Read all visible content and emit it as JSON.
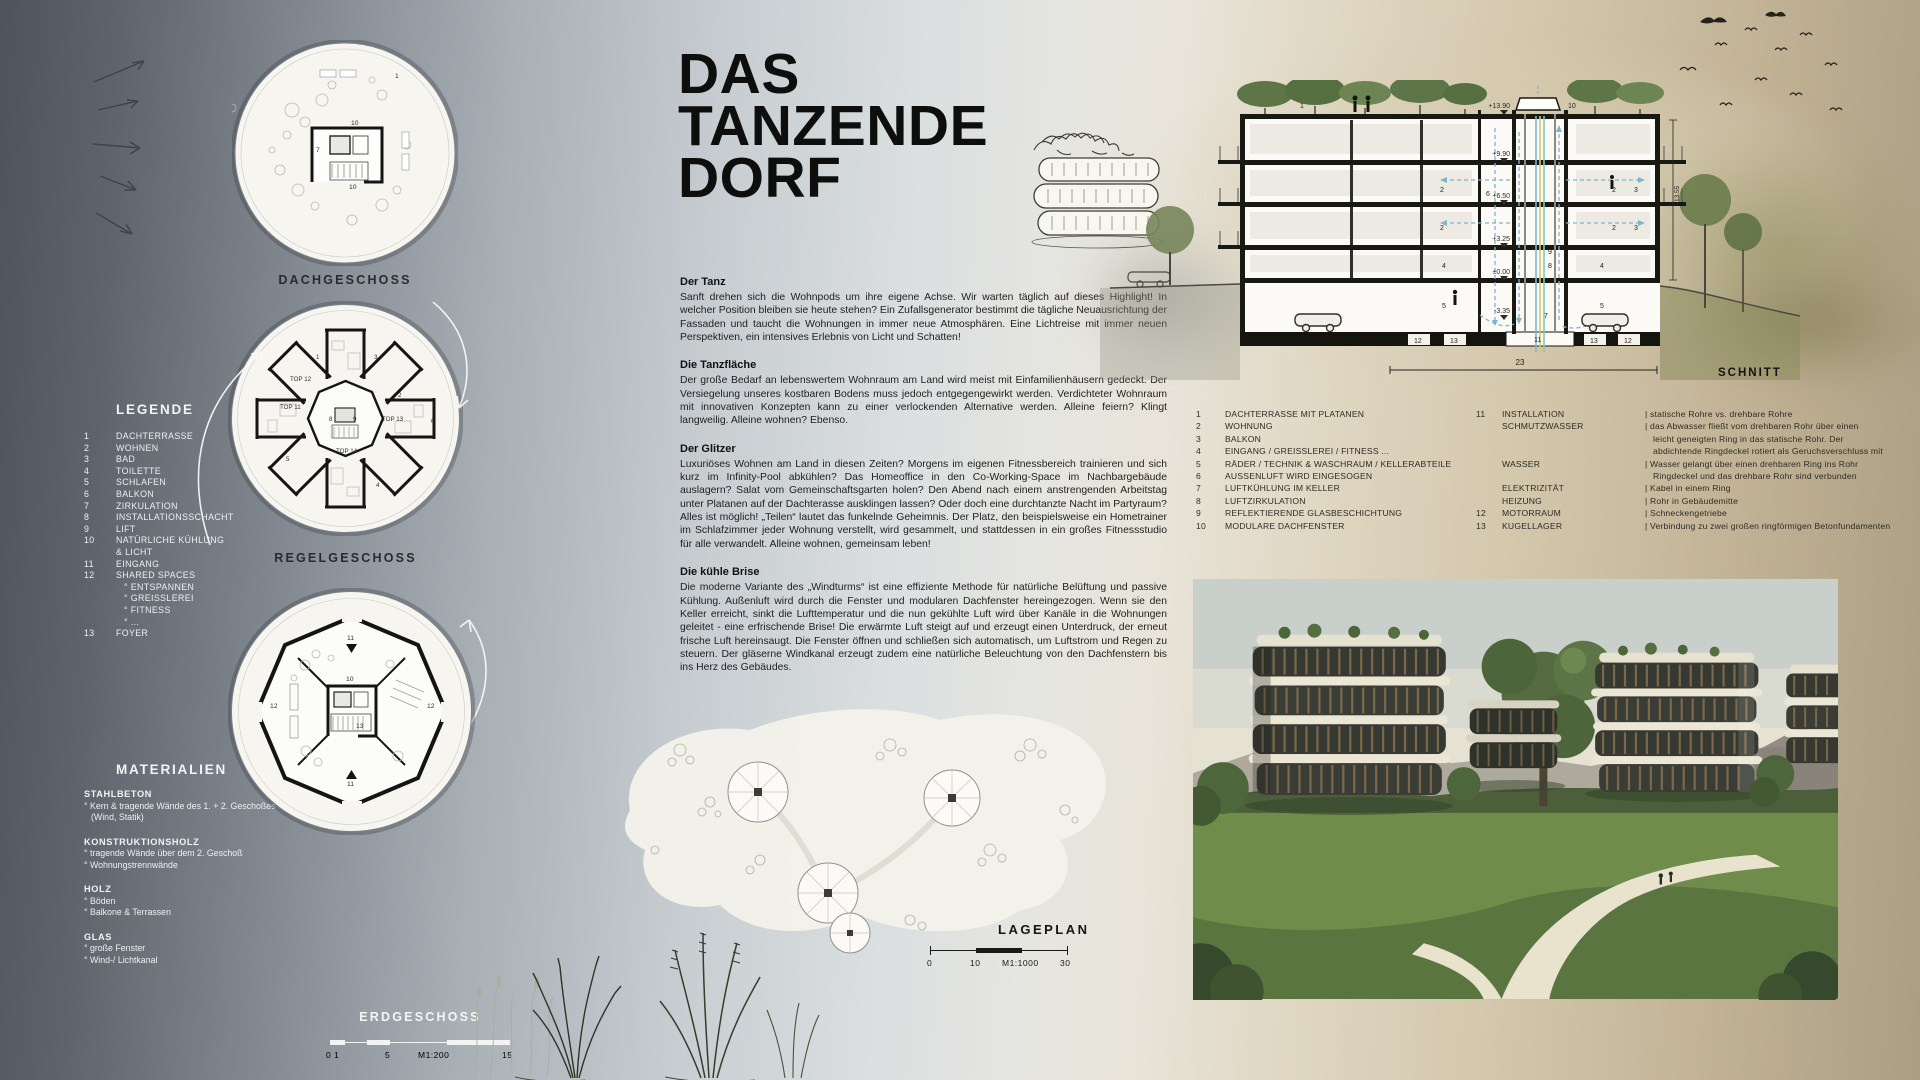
{
  "colors": {
    "accent_air": "#7fb5c9",
    "paper": "#f6f5f0",
    "ink": "#1c1c1c",
    "tree_green": "#5d7547"
  },
  "title": {
    "line1": "DAS",
    "line2": "TANZENDE",
    "line3": "DORF"
  },
  "plans": {
    "dach": {
      "label": "DACHGESCHOSS",
      "n1": "1",
      "n10a": "10",
      "n7": "7",
      "n10b": "10"
    },
    "regel": {
      "label": "REGELGESCHOSS",
      "top12": "TOP 12",
      "top11": "TOP 11",
      "top13": "TOP 13",
      "top14": "TOP 14",
      "n8": "8",
      "n9": "9",
      "n1": "1",
      "n2": "2",
      "n3": "3",
      "n4": "4",
      "n5": "5",
      "n6": "6"
    },
    "erd": {
      "label": "ERDGESCHOSS",
      "n11t": "11",
      "n12l": "12",
      "n12r": "12",
      "n10": "10",
      "n13": "13",
      "n11b": "11"
    },
    "scale": {
      "t0": "0 1",
      "t5": "5",
      "tm": "M1:200",
      "t15": "15"
    }
  },
  "legend": {
    "title": "LEGENDE",
    "rows": [
      {
        "n": "1",
        "t": "DACHTERRASSE"
      },
      {
        "n": "2",
        "t": "WOHNEN"
      },
      {
        "n": "3",
        "t": "BAD"
      },
      {
        "n": "4",
        "t": "TOILETTE"
      },
      {
        "n": "5",
        "t": "SCHLAFEN"
      },
      {
        "n": "6",
        "t": "BALKON"
      },
      {
        "n": "7",
        "t": "ZIRKULATION"
      },
      {
        "n": "8",
        "t": "INSTALLATIONSSCHACHT"
      },
      {
        "n": "9",
        "t": "LIFT"
      },
      {
        "n": "10",
        "t": "NATÜRLICHE KÜHLUNG"
      },
      {
        "n": "",
        "t": "& LICHT"
      },
      {
        "n": "11",
        "t": "EINGANG"
      },
      {
        "n": "12",
        "t": "SHARED SPACES"
      },
      {
        "n": "",
        "t": "° ENTSPANNEN"
      },
      {
        "n": "",
        "t": "° GREISSLEREI"
      },
      {
        "n": "",
        "t": "° FITNESS"
      },
      {
        "n": "",
        "t": "° ..."
      },
      {
        "n": "13",
        "t": "FOYER"
      }
    ]
  },
  "materials": {
    "title": "MATERIALIEN",
    "groups": [
      {
        "h": "STAHLBETON",
        "l1": "° Kern & tragende Wände des 1. + 2. Geschoßes",
        "l2": "(Wind, Statik)"
      },
      {
        "h": "KONSTRUKTIONSHOLZ",
        "l1": "° tragende Wände über dem 2. Geschoß",
        "l2": "° Wohnungstrennwände"
      },
      {
        "h": "HOLZ",
        "l1": "° Böden",
        "l2": "° Balkone & Terrassen"
      },
      {
        "h": "GLAS",
        "l1": "° große Fenster",
        "l2": "° Wind-/ Lichtkanal"
      }
    ]
  },
  "article": {
    "s1_h": "Der Tanz",
    "s1_p": "Sanft drehen sich die Wohnpods um ihre eigene Achse. Wir warten täglich auf dieses Highlight! In welcher Position bleiben sie heute stehen? Ein Zufallsgenerator bestimmt die tägliche Neuausrichtung der Fassaden und taucht die Wohnungen in immer neue Atmosphären. Eine Lichtreise mit immer neuen Perspektiven, ein intensives Erlebnis von Licht und Schatten!",
    "s2_h": "Die Tanzfläche",
    "s2_p": "Der große Bedarf an lebenswertem Wohnraum am Land wird meist mit Einfamilienhäusern gedeckt. Der Versiegelung unseres kostbaren Bodens muss jedoch entgegengewirkt werden. Verdichteter Wohnraum mit innovativen Konzepten kann zu einer verlockenden Alternative werden. Alleine feiern? Klingt langweilig. Alleine wohnen? Ebenso.",
    "s3_h": "Der Glitzer",
    "s3_p1": "Luxuriöses Wohnen am Land in diesen Zeiten? Morgens im eigenen Fitnessbereich trainieren und sich kurz im Infinity-Pool abkühlen? Das Homeoffice in den Co-Working-Space im Nachbargebäude auslagern? Salat vom Gemeinschaftsgarten holen? Den Abend nach einem anstrengenden Arbeitstag unter Platanen auf der Dachterasse ausklingen lassen? Oder doch eine durchtanzte Nacht im Partyraum?",
    "s3_p2": "Alles ist möglich! „Teilen“ lautet das funkelnde Geheimnis. Der Platz, den beispielsweise ein Hometrainer im Schlafzimmer jeder Wohnung verstellt, wird gesammelt, und stattdessen in ein großes Fitnessstudio für alle verwandelt. Alleine wohnen, gemeinsam leben!",
    "s4_h": "Die kühle Brise",
    "s4_p": "Die moderne Variante des „Windturms“ ist eine effiziente Methode für natürliche Belüftung und passive Kühlung. Außenluft wird durch die Fenster und modularen Dachfenster hereingezogen. Wenn sie den Keller erreicht, sinkt die Lufttemperatur und die nun gekühlte Luft wird über Kanäle in die Wohnungen geleitet - eine erfrischende Brise! Die erwärmte Luft steigt auf und erzeugt einen Unterdruck, der erneut frische Luft hereinsaugt. Die Fenster öffnen und schließen sich automatisch, um Luftstrom und Regen zu steuern. Der gläserne Windkanal erzeugt zudem eine natürliche Beleuchtung von den Dachfenstern bis ins Herz des Gebäudes."
  },
  "siteplan": {
    "label": "LAGEPLAN",
    "scale": {
      "t0": "0",
      "t10": "10",
      "tm": "M1:1000",
      "t30": "30"
    }
  },
  "section": {
    "label": "SCHNITT",
    "dim_w": "23",
    "dim_h": "13.55",
    "lv": [
      "+13.90",
      "+9.90",
      "+6.50",
      "+3.25",
      "±0.00",
      "-3.35"
    ],
    "n": {
      "roof": "1",
      "top": "10",
      "left_duct": "6",
      "r9": "9",
      "r8": "8",
      "bot": "7",
      "core": "11",
      "l2a": "2",
      "l2b": "2",
      "l4": "4",
      "l5": "5",
      "r2a": "2",
      "r3a": "3",
      "r2b": "2",
      "r3b": "3",
      "r4": "4",
      "r5": "5",
      "b12l": "12",
      "b13l": "13",
      "b13r": "13",
      "b12r": "12"
    }
  },
  "section_legend": {
    "left": [
      {
        "n": "1",
        "t": "DACHTERRASSE MIT PLATANEN"
      },
      {
        "n": "2",
        "t": "WOHNUNG"
      },
      {
        "n": "3",
        "t": "BALKON"
      },
      {
        "n": "4",
        "t": "EINGANG / GREISSLEREI / FITNESS ..."
      },
      {
        "n": "5",
        "t": "RÄDER / TECHNIK & WASCHRAUM / KELLERABTEILE"
      },
      {
        "n": "6",
        "t": "AUSSENLUFT WIRD EINGESOGEN"
      },
      {
        "n": "7",
        "t": "LUFTKÜHLUNG IM KELLER"
      },
      {
        "n": "8",
        "t": "LUFTZIRKULATION"
      },
      {
        "n": "9",
        "t": "REFLEKTIERENDE GLASBESCHICHTUNG"
      },
      {
        "n": "10",
        "t": "MODULARE DACHFENSTER"
      }
    ],
    "right": [
      {
        "n": "11",
        "t": "INSTALLATION",
        "d": "| statische Rohre vs. drehbare Rohre"
      },
      {
        "n": "",
        "t": "SCHMUTZWASSER",
        "d": "| das Abwasser fließt vom drehbaren Rohr über einen"
      },
      {
        "n": "",
        "t": "",
        "d": "leicht geneigten Ring in das statische Rohr. Der"
      },
      {
        "n": "",
        "t": "",
        "d": "abdichtende Ringdeckel rotiert als Geruchsverschluss mit"
      },
      {
        "n": "",
        "t": "WASSER",
        "d": "| Wasser gelangt über einen drehbaren Ring ins Rohr"
      },
      {
        "n": "",
        "t": "",
        "d": "Ringdeckel und das drehbare Rohr sind verbunden"
      },
      {
        "n": "",
        "t": "ELEKTRIZITÄT",
        "d": "| Kabel in einem Ring"
      },
      {
        "n": "",
        "t": "HEIZUNG",
        "d": "| Rohr in Gebäudemitte"
      },
      {
        "n": "12",
        "t": "MOTORRAUM",
        "d": "| Schneckengetriebe"
      },
      {
        "n": "13",
        "t": "KUGELLAGER",
        "d": "| Verbindung zu zwei großen ringförmigen Betonfundamenten"
      }
    ]
  }
}
